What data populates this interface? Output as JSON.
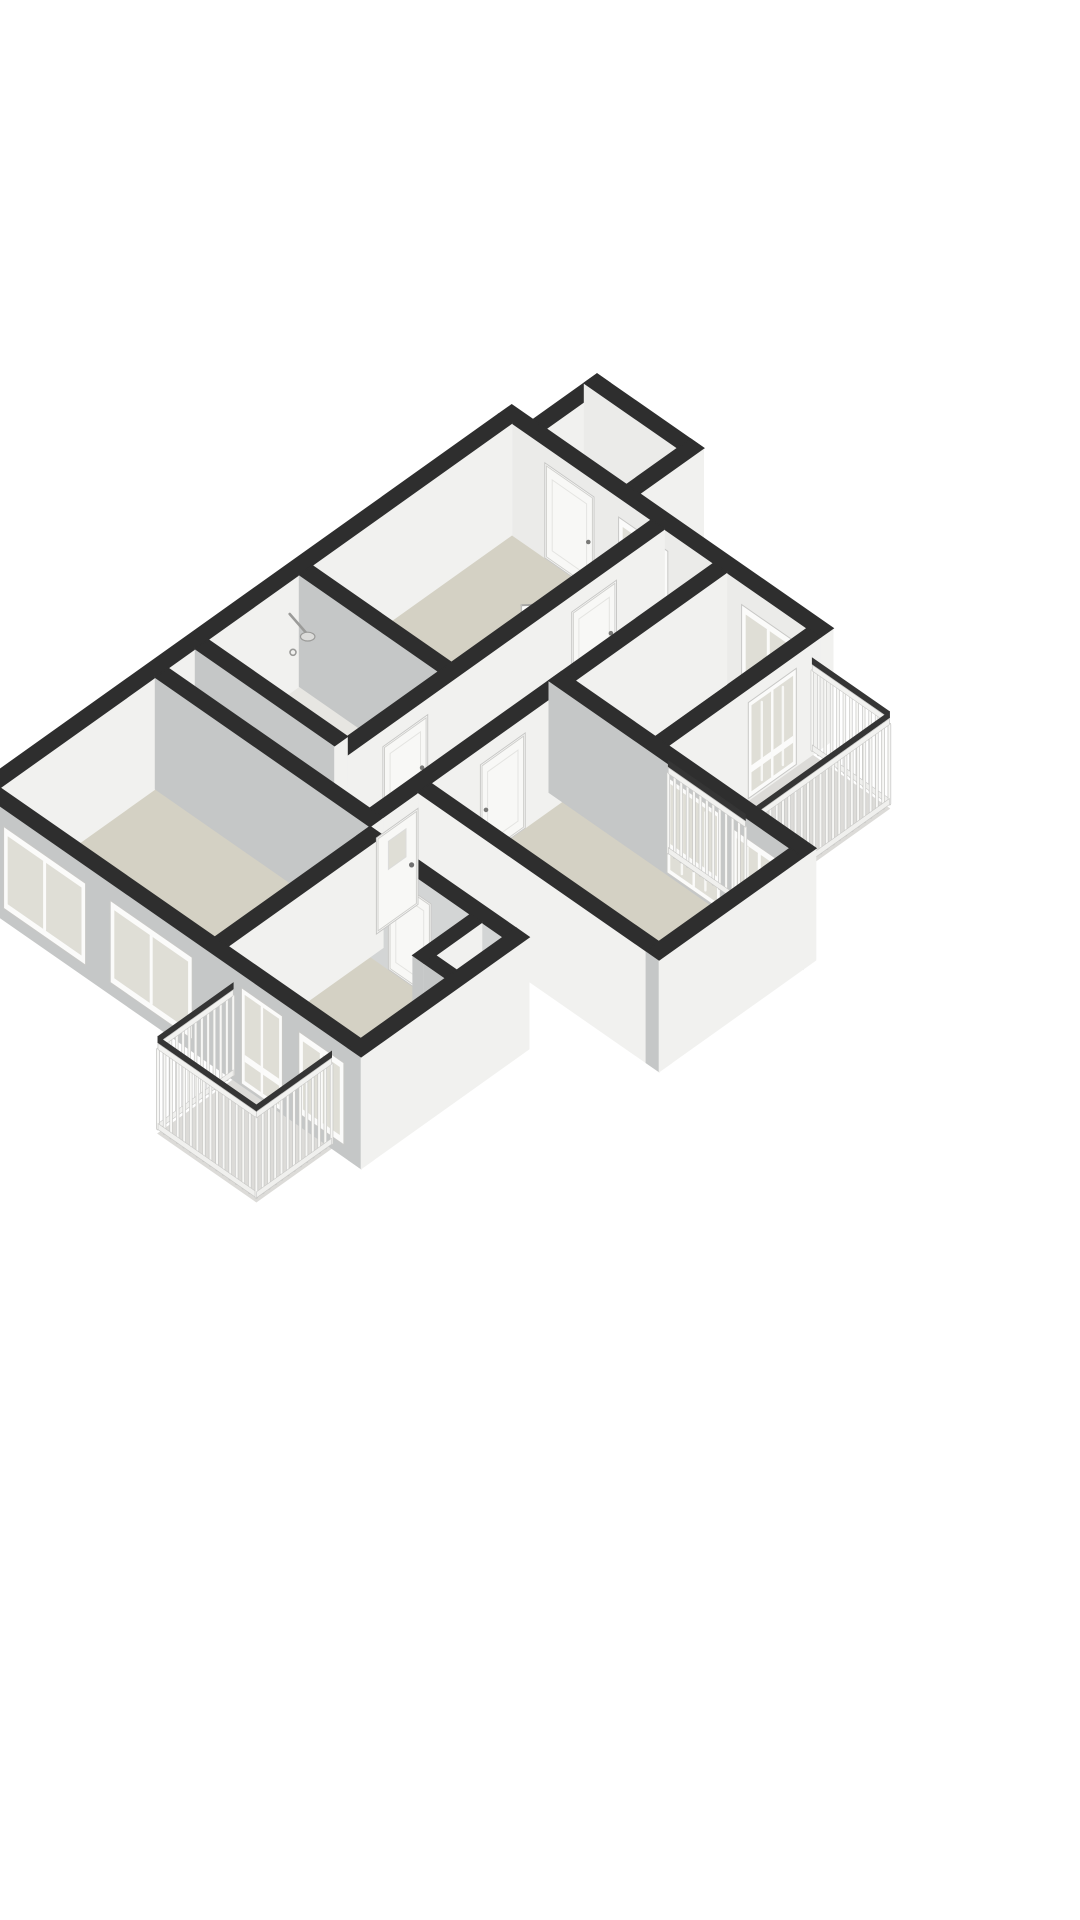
{
  "meta": {
    "type": "3d-floor-plan",
    "view": "isometric",
    "background": "#ffffff"
  },
  "palette": {
    "wallCap": "#2e2e2e",
    "faceSE": "#f1f1ef",
    "faceSW": "#c5c7c7",
    "faceSWlight": "#d3d5d5",
    "faceInner": "#ebebe9",
    "floorBeige": "#d4d1c4",
    "floorBeigeLight": "#dad7cc",
    "floorPale": "#e7e6e2",
    "floorBalcony": "#dcdbd8",
    "frame": "#fbfbfa",
    "frameEdge": "#c8c8c6",
    "glass": "#dfded6",
    "door": "#f8f8f6",
    "doorEdge": "#cfcfcc",
    "handle": "#7a7a78",
    "slat": "#f7f7f5",
    "slatEdge": "#c9c9c7",
    "railTop": "#353535",
    "fixture": "#9b9b99",
    "fixtureLight": "#dcdcda",
    "accentRed": "#b23b30",
    "accentDark": "#303030"
  },
  "projection": {
    "x0": 512,
    "y0": 535,
    "pX": 0.82,
    "pY": 0.57,
    "qX": -0.8,
    "qY": 0.57,
    "wallHeight": 112,
    "railHeight": 92
  },
  "floors": [
    {
      "name": "floor-storage-room",
      "color": "floorPale",
      "rect": [
        26,
        -80,
        124,
        -16
      ]
    },
    {
      "name": "floor-bedroom-top",
      "color": "floorBeige",
      "rect": [
        0,
        0,
        170,
        250
      ]
    },
    {
      "name": "floor-hallway",
      "color": "floorBeigeLight",
      "rect": [
        186,
        0,
        246,
        430
      ]
    },
    {
      "name": "floor-bedroom-right",
      "color": "floorBeige",
      "rect": [
        262,
        16,
        360,
        190
      ]
    },
    {
      "name": "floor-room-right-lower",
      "color": "floorBeige",
      "rect": [
        262,
        206,
        540,
        370
      ]
    },
    {
      "name": "floor-bathroom",
      "color": "floorPale",
      "rect": [
        0,
        266,
        170,
        380
      ]
    },
    {
      "name": "floor-toilet",
      "color": "floorPale",
      "rect": [
        0,
        396,
        170,
        430
      ]
    },
    {
      "name": "floor-living-room",
      "color": "floorBeige",
      "rect": [
        0,
        446,
        262,
        640
      ]
    },
    {
      "name": "floor-bedroom-bottom",
      "color": "floorBeige",
      "rect": [
        278,
        462,
        440,
        640
      ]
    },
    {
      "name": "floor-balcony-east",
      "color": "floorBalcony",
      "rect": [
        376,
        10,
        470,
        190
      ]
    },
    {
      "name": "floor-balcony-south",
      "color": "floorBalcony",
      "rect": [
        300,
        656,
        420,
        750
      ]
    }
  ],
  "walls": [
    {
      "name": "wall-ne-facade",
      "rect": [
        -16,
        -16,
        376,
        0
      ],
      "faceQ": "faceInner",
      "openings": [
        {
          "name": "door-storage-room",
          "type": "door",
          "face": "q",
          "s1": 40,
          "s2": 100,
          "z1": 0,
          "z2": 95,
          "handle": "end"
        },
        {
          "name": "window-hall-top",
          "type": "window",
          "face": "q",
          "s1": 130,
          "s2": 190,
          "z1": 12,
          "z2": 92
        },
        {
          "name": "window-bedroom-right-north",
          "type": "window",
          "face": "q",
          "s1": 280,
          "s2": 345,
          "z1": 15,
          "z2": 90
        }
      ]
    },
    {
      "name": "wall-nw-facade",
      "rect": [
        -16,
        0,
        0,
        656
      ],
      "faceP": "faceSE"
    },
    {
      "name": "wall-storage-west",
      "rect": [
        10,
        -96,
        26,
        -16
      ]
    },
    {
      "name": "wall-storage-north",
      "rect": [
        10,
        -96,
        140,
        -80
      ],
      "faceQ": "faceInner"
    },
    {
      "name": "wall-storage-east",
      "rect": [
        124,
        -96,
        140,
        -16
      ]
    },
    {
      "name": "wall-hall-west",
      "rect": [
        170,
        0,
        186,
        430
      ],
      "openings": [
        {
          "name": "door-bedroom-top",
          "type": "door",
          "face": "p",
          "s1": 60,
          "s2": 116,
          "z1": 0,
          "z2": 95,
          "handle": "start"
        },
        {
          "name": "door-bathroom",
          "type": "door",
          "face": "p",
          "s1": 296,
          "s2": 352,
          "z1": 0,
          "z2": 95,
          "handle": "start"
        },
        {
          "name": "door-toilet",
          "type": "door",
          "face": "p",
          "s1": 398,
          "s2": 426,
          "z1": 0,
          "z2": 95,
          "handle": "start"
        }
      ]
    },
    {
      "name": "wall-bedroom-top-south",
      "rect": [
        0,
        250,
        170,
        266
      ]
    },
    {
      "name": "wall-hall-east",
      "rect": [
        246,
        0,
        262,
        446
      ],
      "openings": [
        {
          "name": "door-room-right-lower",
          "type": "door",
          "face": "p",
          "s1": 252,
          "s2": 308,
          "z1": 0,
          "z2": 95,
          "handle": "end"
        },
        {
          "name": "front-door",
          "type": "front-door",
          "face": "p",
          "s1": 386,
          "s2": 438,
          "z1": 0,
          "z2": 96,
          "late": true
        }
      ]
    },
    {
      "name": "wall-room-right-south",
      "rect": [
        262,
        370,
        556,
        386
      ],
      "faceQ": "faceSE"
    },
    {
      "name": "wall-south-facade",
      "rect": [
        0,
        640,
        456,
        656
      ],
      "openings": [
        {
          "name": "window-living-1",
          "type": "window",
          "face": "q",
          "s1": 20,
          "s2": 120,
          "z1": 12,
          "z2": 94
        },
        {
          "name": "window-living-2",
          "type": "window",
          "face": "q",
          "s1": 150,
          "s2": 250,
          "z1": 12,
          "z2": 94
        },
        {
          "name": "glass-door-balcony-south",
          "type": "glass-door",
          "face": "q",
          "s1": 310,
          "s2": 360,
          "z1": 2,
          "z2": 98
        },
        {
          "name": "window-bedroom-bottom",
          "type": "window",
          "face": "q",
          "s1": 380,
          "s2": 435,
          "z1": 12,
          "z2": 94
        }
      ]
    },
    {
      "name": "wall-bedroom-bottom-north",
      "rect": [
        262,
        446,
        440,
        462
      ],
      "faceQ": "faceSWlight",
      "openings": [
        {
          "name": "door-bedroom-bottom",
          "type": "door",
          "face": "q",
          "s1": 300,
          "s2": 352,
          "z1": 0,
          "z2": 95,
          "handle": "end"
        }
      ]
    },
    {
      "name": "wall-bedroom-bottom-east",
      "rect": [
        440,
        446,
        456,
        656
      ]
    },
    {
      "name": "wall-living-east",
      "rect": [
        262,
        446,
        278,
        656
      ]
    },
    {
      "name": "wall-living-north",
      "rect": [
        0,
        430,
        262,
        446
      ]
    },
    {
      "name": "wall-bathroom-south",
      "rect": [
        0,
        380,
        170,
        396
      ]
    },
    {
      "name": "wall-mid-east",
      "rect": [
        246,
        190,
        556,
        206
      ],
      "openings": [
        {
          "name": "glass-door-balcony-east",
          "type": "glass-door",
          "face": "q",
          "s1": 390,
          "s2": 455,
          "z1": 2,
          "z2": 98,
          "slats": true
        },
        {
          "name": "window-room-right-lower",
          "type": "window",
          "face": "q",
          "s1": 470,
          "s2": 535,
          "z1": 22,
          "z2": 92,
          "slats": true
        }
      ]
    },
    {
      "name": "wall-bedroom-right-east",
      "rect": [
        360,
        0,
        376,
        190
      ],
      "openings": [
        {
          "name": "glass-door-bedroom-right",
          "type": "glass-door",
          "face": "p",
          "s1": 30,
          "s2": 90,
          "z1": 2,
          "z2": 98,
          "slats": true
        }
      ]
    },
    {
      "name": "wall-room-right-east",
      "rect": [
        540,
        206,
        556,
        386
      ]
    },
    {
      "name": "wall-closet-a",
      "rect": [
        400,
        462,
        414,
        534
      ]
    },
    {
      "name": "wall-closet-b",
      "rect": [
        414,
        520,
        440,
        534
      ]
    }
  ],
  "railings": [
    {
      "name": "railing-balcony-east-ne",
      "from": [
        376,
        10
      ],
      "to": [
        470,
        10
      ]
    },
    {
      "name": "railing-balcony-east-outer",
      "from": [
        470,
        10
      ],
      "to": [
        470,
        190
      ],
      "bias": -40
    },
    {
      "name": "railing-balcony-east-se",
      "from": [
        376,
        190
      ],
      "to": [
        470,
        190
      ],
      "bias": -40
    },
    {
      "name": "railing-balcony-south-west",
      "from": [
        300,
        656
      ],
      "to": [
        300,
        750
      ]
    },
    {
      "name": "railing-balcony-south-outer",
      "from": [
        300,
        750
      ],
      "to": [
        420,
        750
      ]
    },
    {
      "name": "railing-balcony-south-east",
      "from": [
        420,
        656
      ],
      "to": [
        420,
        750
      ]
    }
  ],
  "leaves": [
    {
      "name": "open-door-leaf-bedroom-top",
      "from": [
        170,
        116
      ],
      "to": [
        148,
        140
      ]
    },
    {
      "name": "open-door-leaf-bedroom-right",
      "from": [
        262,
        96
      ],
      "to": [
        288,
        78
      ]
    }
  ],
  "fixtures": [
    {
      "name": "shower-icon",
      "type": "shower",
      "wall": [
        4,
        282
      ],
      "head": [
        26,
        282
      ],
      "drain": [
        34,
        298
      ]
    },
    {
      "name": "washbasin-icon",
      "type": "washbasin",
      "rect": [
        4,
        398,
        52,
        430
      ],
      "h": 46
    },
    {
      "name": "coat-rack-icon",
      "type": "coat-rack",
      "hooks": [
        [
          420,
          478
        ],
        [
          429,
          486
        ],
        [
          438,
          494
        ]
      ],
      "hookColors": [
        "accentRed",
        "accentRed",
        "accentDark"
      ]
    }
  ]
}
